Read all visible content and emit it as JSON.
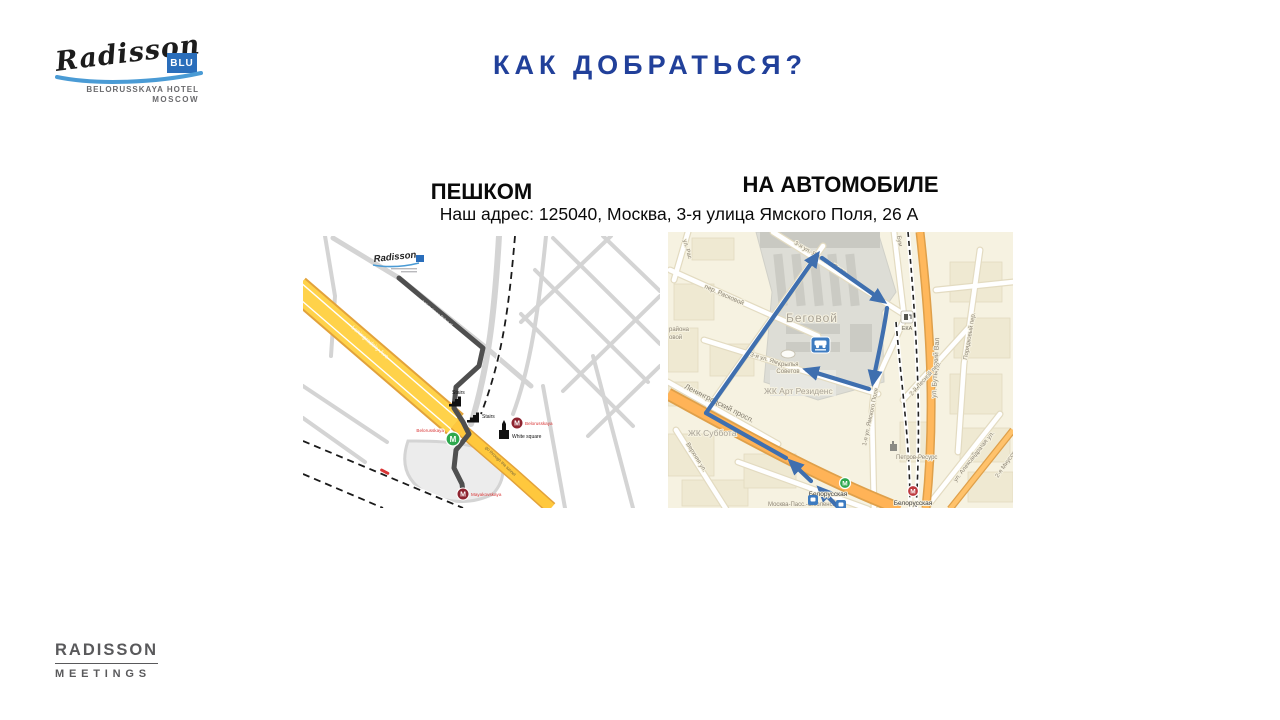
{
  "colors": {
    "title_blue": "#21409A",
    "logo_blue": "#2A6EBB",
    "swoosh_blue": "#4A9BD5",
    "route_arrow_blue": "#3F6FAF",
    "walk_route_gray": "#4F4F4F",
    "highway_yellow": "#FFD24A",
    "yandex_road_orange": "#FFB85C",
    "metro_green": "#2EA84E",
    "metro_red_dark": "#8E2430",
    "metro_red_bright": "#BE3A3F",
    "footer_gray": "#59595B"
  },
  "header": {
    "logo": {
      "brand": "Radisson",
      "blu": "BLU",
      "line1": "BELORUSSKAYA HOTEL",
      "line2": "MOSCOW"
    },
    "title": "КАК ДОБРАТЬСЯ?"
  },
  "sections": {
    "walk_heading": "ПЕШКОМ",
    "car_heading": "НА АВТОМОБИЛЕ",
    "address": "Наш адрес: 125040, Москва, 3-я улица Ямского Поля, 26 А"
  },
  "walk_map": {
    "hotel_logo": "Radisson",
    "road_label": "Leningradsky Ave",
    "tunnel_label": "go through the tunnel",
    "route_street_label": "3 Yamskogo Polya st",
    "stairs1": "Stairs",
    "stairs2": "Stairs",
    "white_square": "White square",
    "metro_green_label": "Belorusskaya",
    "metro_red1_label": "Belorusskaya",
    "metro_red2_label": "Mayakovskaya",
    "metro_letter": "M"
  },
  "car_map": {
    "district": "Беговой",
    "zhk_art": "ЖК Арт Резиденс",
    "zhk_subbota": "ЖК Суббота",
    "krylya1": "Крылья",
    "krylya2": "Советов",
    "rayona1": "района",
    "rayona2": "овой",
    "per_raskovoy": "пер. Расковой",
    "ul_ras": "ул. Рас",
    "street_3ya_top": "3-я ул. Ямского Поля",
    "street_3ya_hotel": "3-я ул. Ям",
    "street_1ya": "1-я ул. Ямского Поля",
    "butyrsky": "ул. Бутырский Вал",
    "bumazhny": "Бум",
    "poryadkovy": "Порядковый пер.",
    "lesnoy2": "2-й Лесной пер.",
    "lesnaya": "Лесная ул.",
    "aleksandra": "ул. Александра",
    "miusskaya2": "2-я Миусская",
    "verkhnyaya": "Верхняя ул.",
    "leningradsky": "Ленинградский просп.",
    "petrov": "Петров-Ресурс",
    "eka": "ЕКА",
    "metro_green_label": "Белорусская",
    "metro_red_label": "Белорусская",
    "moskva_pass": "Москва-Пасс.-Смоленская",
    "metro_letter": "М"
  },
  "footer": {
    "line1": "RADISSON",
    "line2": "MEETINGS"
  }
}
